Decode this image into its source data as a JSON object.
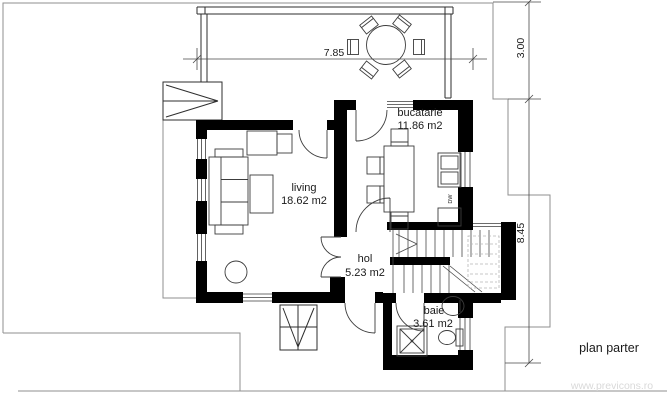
{
  "drawing": {
    "title": "plan parter",
    "watermark": "www.previcons.ro"
  },
  "rooms": {
    "living": {
      "name": "living",
      "area": "18.62 m2"
    },
    "kitchen": {
      "name": "bucatarie",
      "area": "11.86 m2"
    },
    "hall": {
      "name": "hol",
      "area": "5.23 m2"
    },
    "bathroom": {
      "name": "baie",
      "area": "3.61 m2"
    }
  },
  "appliances": {
    "dishwasher": "DW"
  },
  "dimensions": {
    "terrace_width": "7.85",
    "terrace_depth": "3.00",
    "house_depth": "8.45"
  },
  "colors": {
    "wall": "#000000",
    "line": "#3c3c3c",
    "site_line": "#8f8f8f",
    "watermark": "#d9d9d9"
  }
}
